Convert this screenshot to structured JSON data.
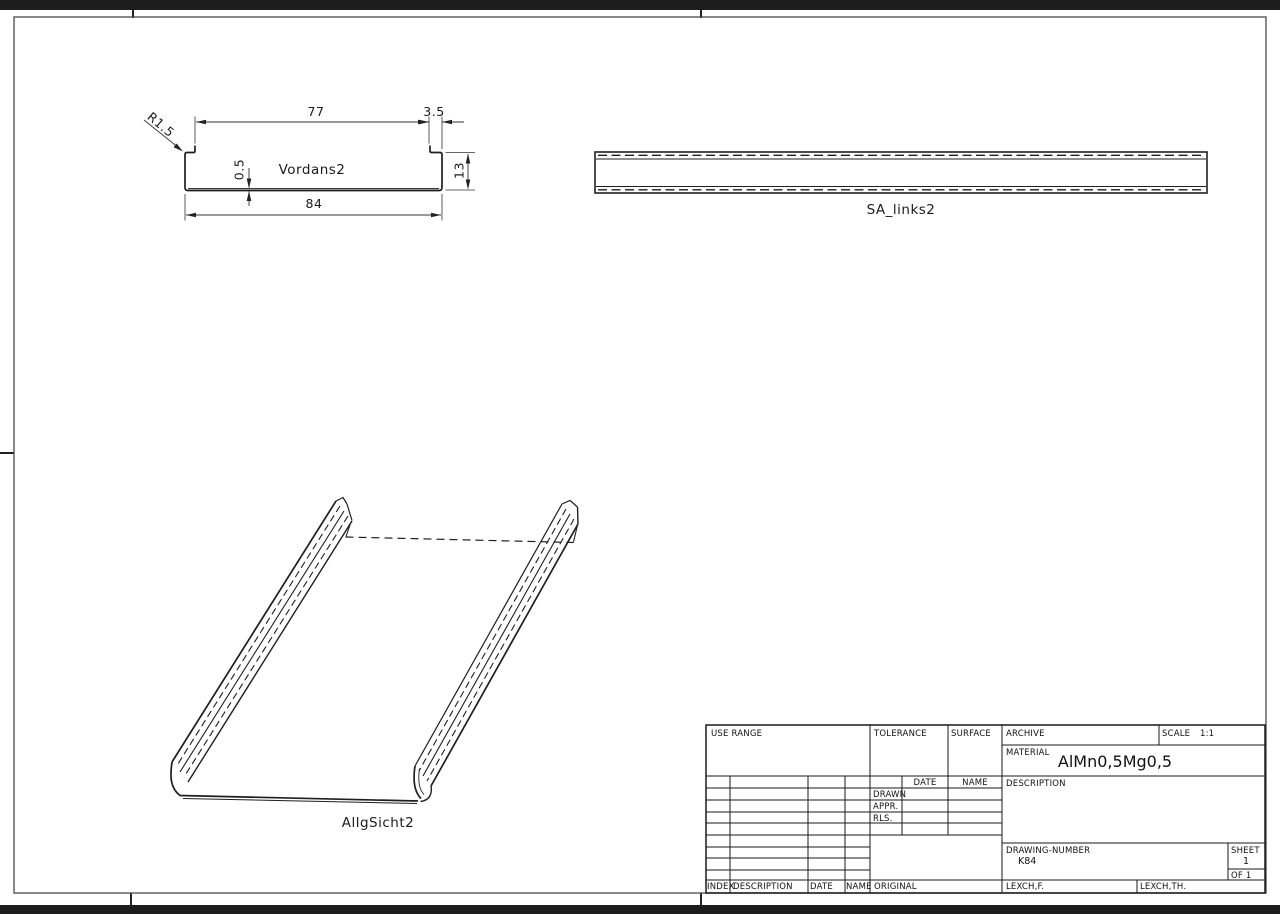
{
  "drawing": {
    "views": {
      "section": {
        "label": "Vordans2",
        "dim_top_width": "77",
        "dim_lip_offset": "3.5",
        "dim_bottom_width": "84",
        "dim_height": "13",
        "dim_thickness": "0.5",
        "dim_radius": "R1.5"
      },
      "side": {
        "label": "SA_links2"
      },
      "iso": {
        "label": "AllgSicht2"
      }
    },
    "title_block": {
      "use_range": "USE RANGE",
      "tolerance": "TOLERANCE",
      "surface": "SURFACE",
      "archive": "ARCHIVE",
      "scale_label": "SCALE",
      "scale_value": "1:1",
      "material_label": "MATERIAL",
      "material_value": "AlMn0,5Mg0,5",
      "description_label": "DESCRIPTION",
      "sign_date": "DATE",
      "sign_name": "NAME",
      "drawn": "DRAWN",
      "appr": "APPR.",
      "rls": "RLS.",
      "drawing_number_label": "DRAWING-NUMBER",
      "drawing_number_value": "K84",
      "sheet_label": "SHEET",
      "sheet_value": "1",
      "of_value": "OF 1",
      "rev_index": "INDEX",
      "rev_description": "DESCRIPTION",
      "rev_date": "DATE",
      "rev_name": "NAME",
      "original": "ORIGINAL",
      "lexch_f": "LEXCH,F.",
      "lexch_th": "LEXCH,TH."
    }
  }
}
